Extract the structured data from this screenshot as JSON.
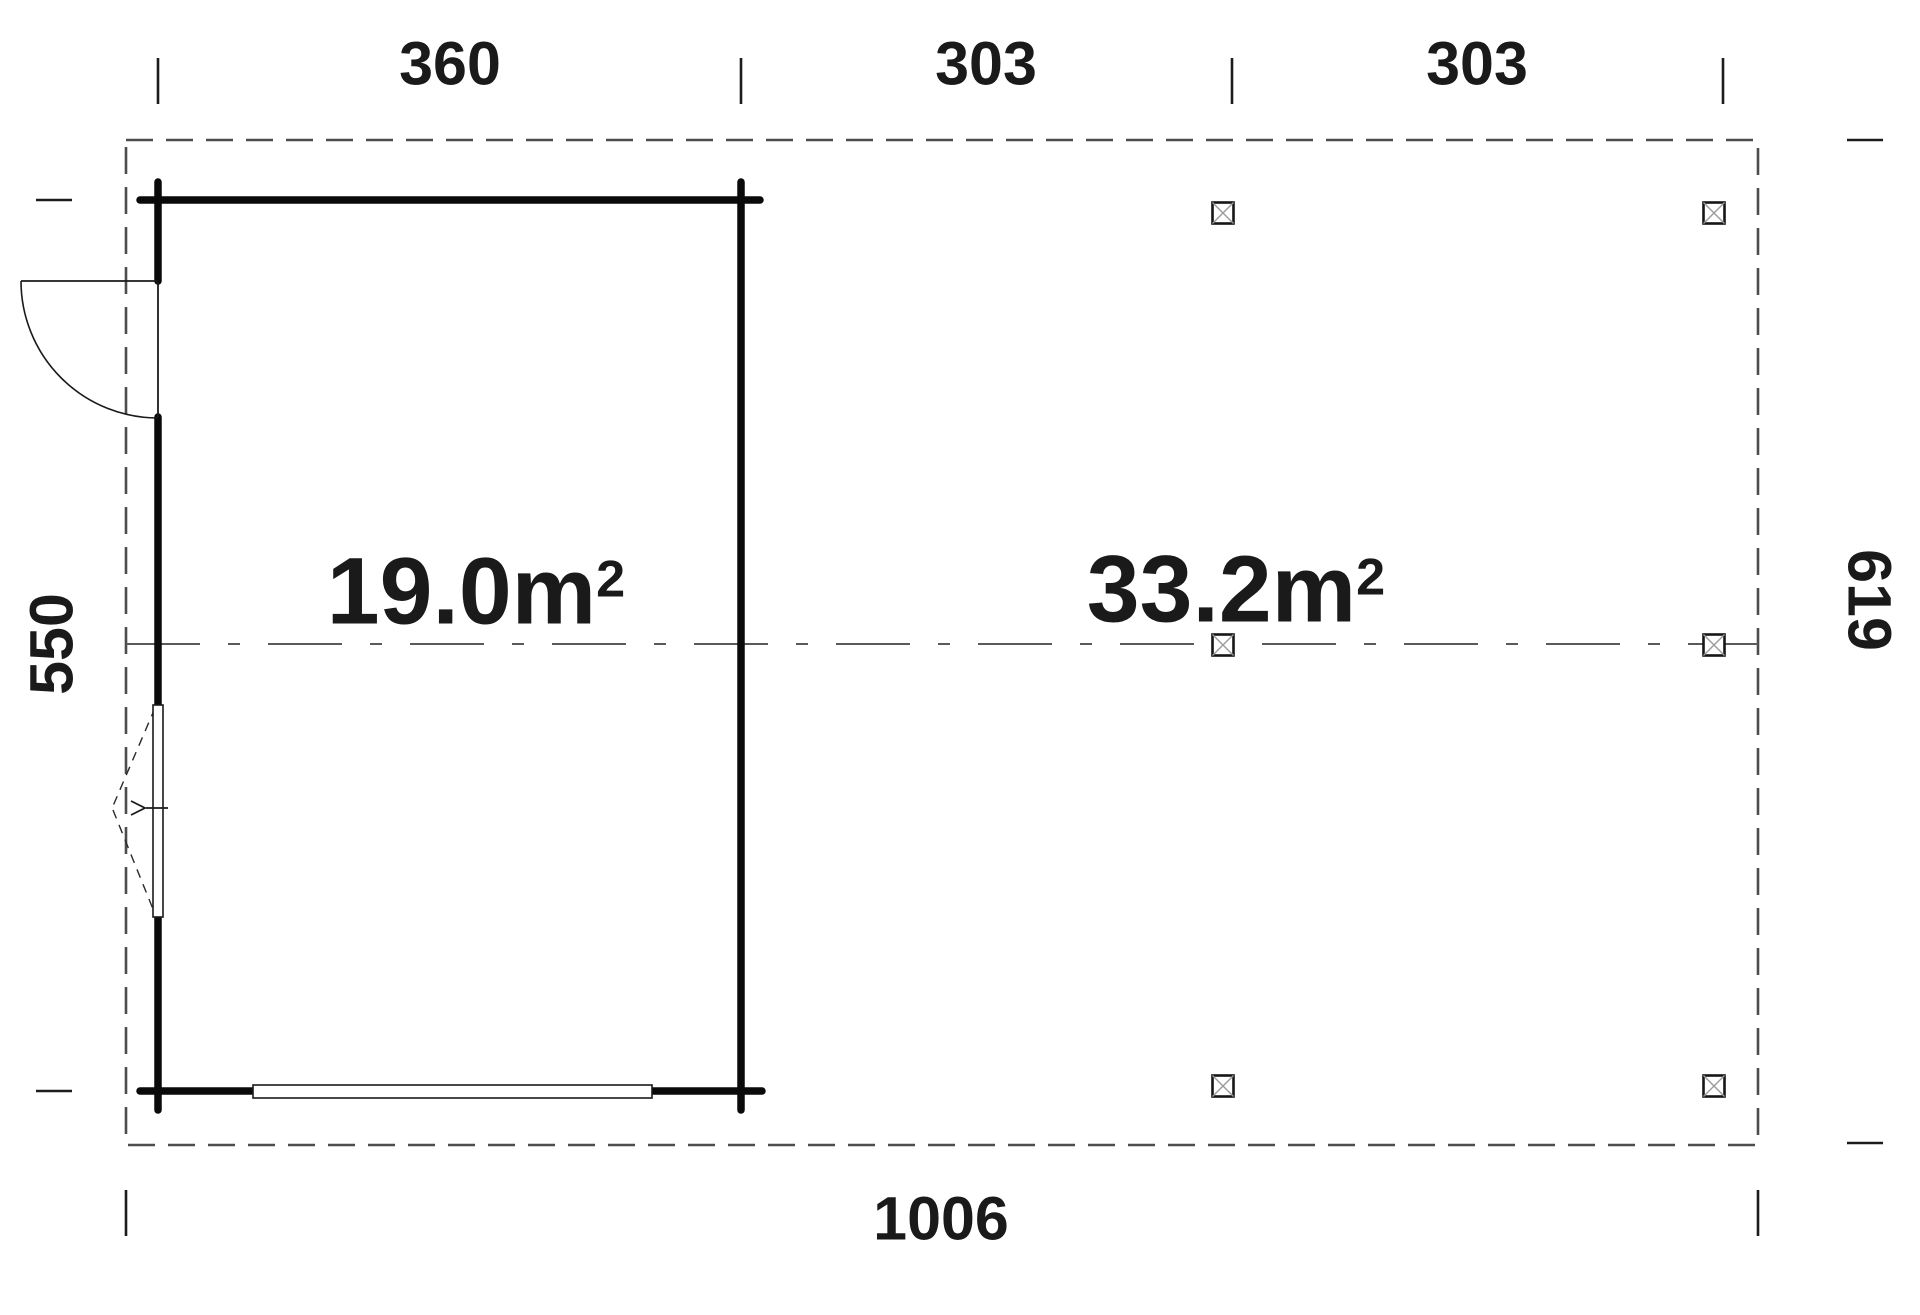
{
  "plan": {
    "dimensions": {
      "top": [
        "360",
        "303",
        "303"
      ],
      "left": "550",
      "right": "619",
      "bottom": "1006"
    },
    "areas": {
      "room": {
        "value": "19.0m",
        "sup": "2"
      },
      "carport": {
        "value": "33.2m",
        "sup": "2"
      }
    },
    "colors": {
      "wall": "#0a0a0a",
      "outline_dash": "#4d4d4d",
      "centerline": "#5a5a5a",
      "text": "#1a1a1a",
      "post_cross": "#9a9a9a"
    }
  }
}
